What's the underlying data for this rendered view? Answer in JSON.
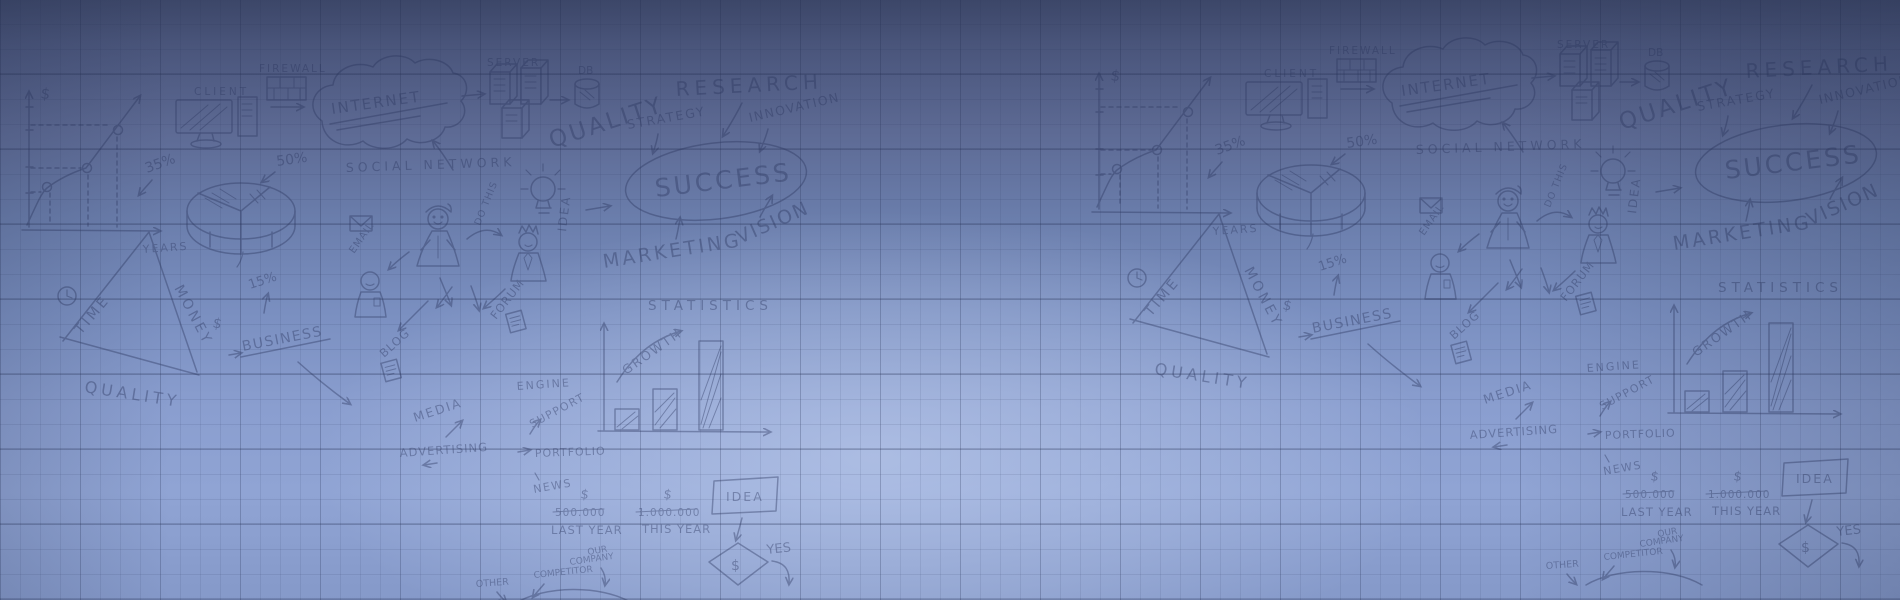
{
  "banner": {
    "description": "blue gradient graph-paper banner with hand-drawn business doodles",
    "colors": {
      "top": "#485377",
      "middle": "#7a8fc0",
      "glow_center": "#96aadb",
      "bottom": "#8599c9",
      "grid_line": "#26325a",
      "doodle_ink": "#2c3760"
    },
    "doodles": {
      "client": "CLIENT",
      "firewall": "FIREWALL",
      "internet": "INTERNET",
      "server": "SERVER",
      "db": "DB",
      "quality": "QUALITY",
      "strategy": "STRATEGY",
      "research": "RESEARCH",
      "innovation": "INNOVATION",
      "social_network": "SOCIAL NETWORK",
      "success": "SUCCESS",
      "vision": "VISION",
      "marketing": "MARKETING",
      "idea": "IDEA",
      "do_this": "DO THIS",
      "email": "EMAIL",
      "pct_35": "35%",
      "pct_50": "50%",
      "pct_15": "15%",
      "years": "YEARS",
      "dollar": "$",
      "time": "TIME",
      "money": "MONEY",
      "quality_triangle": "QUALITY",
      "business": "BUSINESS",
      "blog": "BLOG",
      "forum": "FORUM",
      "media": "MEDIA",
      "advertising": "ADVERTISING",
      "engine": "ENGINE",
      "support": "SUPPORT",
      "portfolio": "PORTFOLIO",
      "news": "NEWS",
      "statistics": "STATISTICS",
      "growth": "GROWTH",
      "amount_last_year": "500.000",
      "last_year": "LAST YEAR",
      "amount_this_year": "1.000.000",
      "this_year": "THIS YEAR",
      "yes": "YES",
      "our": "OUR",
      "company": "COMPANY",
      "competitor": "COMPETITOR",
      "other": "OTHER"
    }
  }
}
